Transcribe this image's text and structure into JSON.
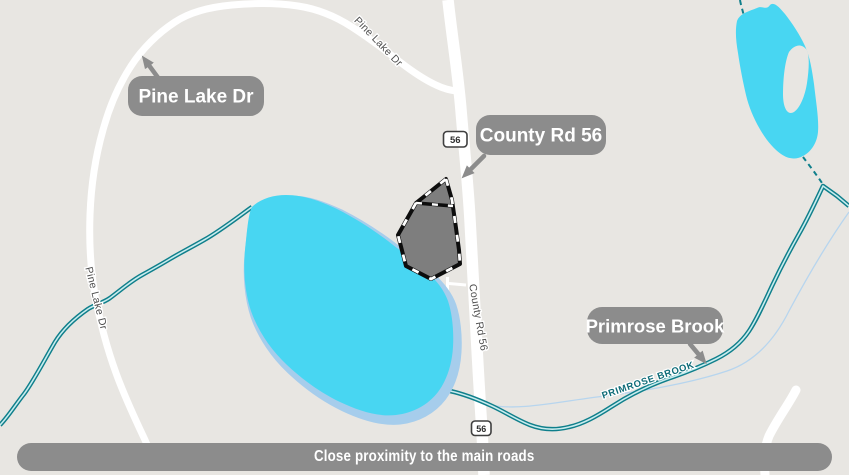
{
  "map": {
    "bubbles": {
      "pine_lake_dr": "Pine Lake Dr",
      "county_rd_56": "County Rd 56",
      "primrose_brook": "Primrose Brook"
    },
    "road_labels": {
      "pine_lake_dr_top": "Pine Lake Dr",
      "pine_lake_dr_west": "Pine Lake Dr",
      "county_rd_56": "County Rd 56"
    },
    "water_labels": {
      "primrose_brook": "PRIMROSE BROOK"
    },
    "shields": {
      "north": "56",
      "south": "56"
    },
    "banner": "Close proximity to the main roads",
    "colors": {
      "bg": "#e8e6e2",
      "road": "#ffffff",
      "water": "#48d6f2",
      "water_halo": "#a6cdec",
      "stream": "#0f7f8b",
      "stream_core": "#c8ecee",
      "thin_stream": "#b7d5ee",
      "parcel_fill": "#7e7e7e",
      "parcel_stroke": "#0d0d0d",
      "bubble_bg": "#8c8c8c",
      "bubble_text": "#ffffff",
      "road_label": "#4f4f4f",
      "brook_label": "#0d6b77",
      "shield_border": "#3f3f3f",
      "shield_text": "#2e2e2e"
    }
  }
}
